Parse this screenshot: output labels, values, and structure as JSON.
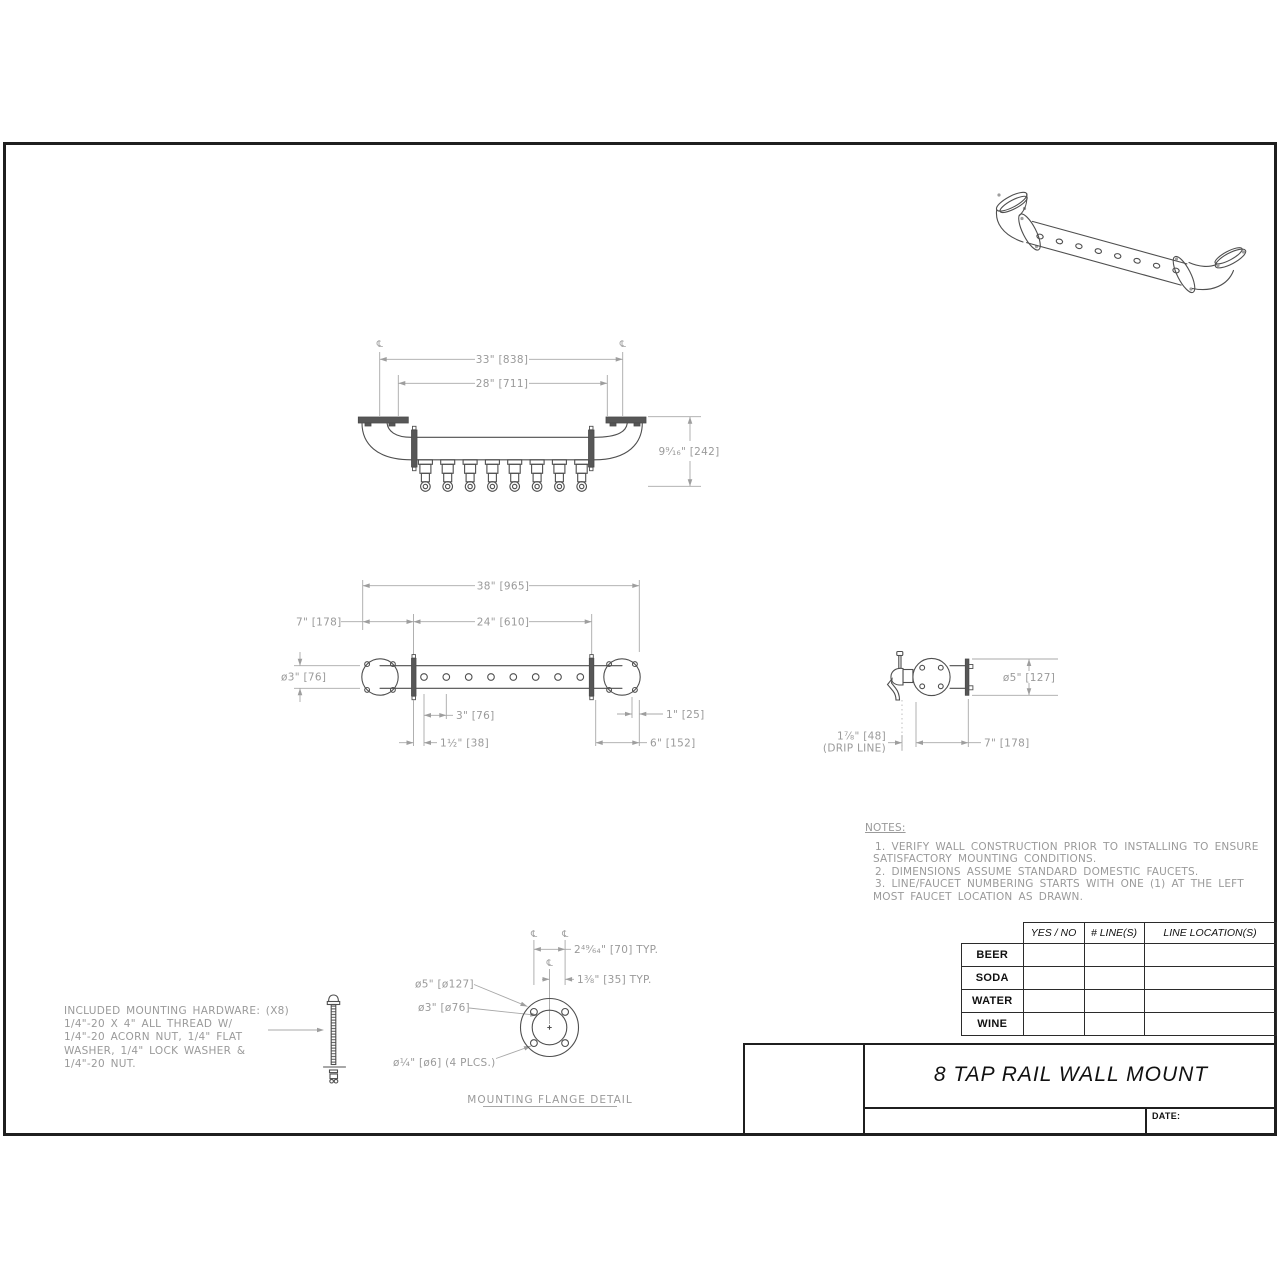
{
  "sheet": {
    "title": "8 TAP RAIL WALL MOUNT",
    "date_label": "DATE:"
  },
  "symbols": {
    "centerline": "℄"
  },
  "front_view": {
    "dim_overall": "33\" [838]",
    "dim_inner": "28\" [711]",
    "dim_height": "9⁹⁄₁₆\" [242]"
  },
  "top_view": {
    "dim_overall": "38\" [965]",
    "dim_left_offset": "7\" [178]",
    "dim_center": "24\" [610]",
    "dim_tube_dia": "ø3\" [76]",
    "dim_spacing": "3\" [76]",
    "dim_first_offset": "1½\" [38]",
    "dim_end": "1\" [25]",
    "dim_flange": "6\" [152]"
  },
  "side_view": {
    "dim_flange_dia": "ø5\" [127]",
    "dim_drip_line_1": "1⅞\" [48]",
    "dim_drip_line_2": "(DRIP LINE)",
    "dim_wall_offset": "7\" [178]"
  },
  "flange_detail": {
    "dim_bolt_spacing": "2⁴⁹⁄₆₄\" [70] TYP.",
    "dim_bolt_offset": "1⅜\" [35] TYP.",
    "dim_outer_dia": "ø5\" [ø127]",
    "dim_tube_dia": "ø3\" [ø76]",
    "dim_bolt_holes": "ø¼\" [ø6] (4 PLCS.)",
    "caption": "MOUNTING FLANGE DETAIL"
  },
  "hardware_note": {
    "lines": [
      "INCLUDED MOUNTING HARDWARE: (X8)",
      "1/4\"-20 X 4\" ALL THREAD W/",
      "1/4\"-20 ACORN NUT, 1/4\" FLAT",
      "WASHER, 1/4\" LOCK WASHER &",
      "1/4\"-20 NUT."
    ]
  },
  "notes": {
    "heading": "NOTES:",
    "lines": [
      "1. VERIFY WALL CONSTRUCTION PRIOR TO INSTALLING TO ENSURE",
      "SATISFACTORY MOUNTING CONDITIONS.",
      "2. DIMENSIONS ASSUME STANDARD DOMESTIC FAUCETS.",
      "3. LINE/FAUCET NUMBERING STARTS WITH ONE (1) AT THE LEFT",
      "MOST FAUCET LOCATION AS DRAWN."
    ]
  },
  "line_table": {
    "col_headers": [
      "YES / NO",
      "# LINE(S)",
      "LINE LOCATION(S)"
    ],
    "row_labels": [
      "BEER",
      "SODA",
      "WATER",
      "WINE"
    ]
  },
  "colors": {
    "object_line": "#4f4f4f",
    "dimension_line": "#a8a8a8",
    "dimension_text": "#9a9a9a",
    "frame": "#1f1f1f"
  }
}
